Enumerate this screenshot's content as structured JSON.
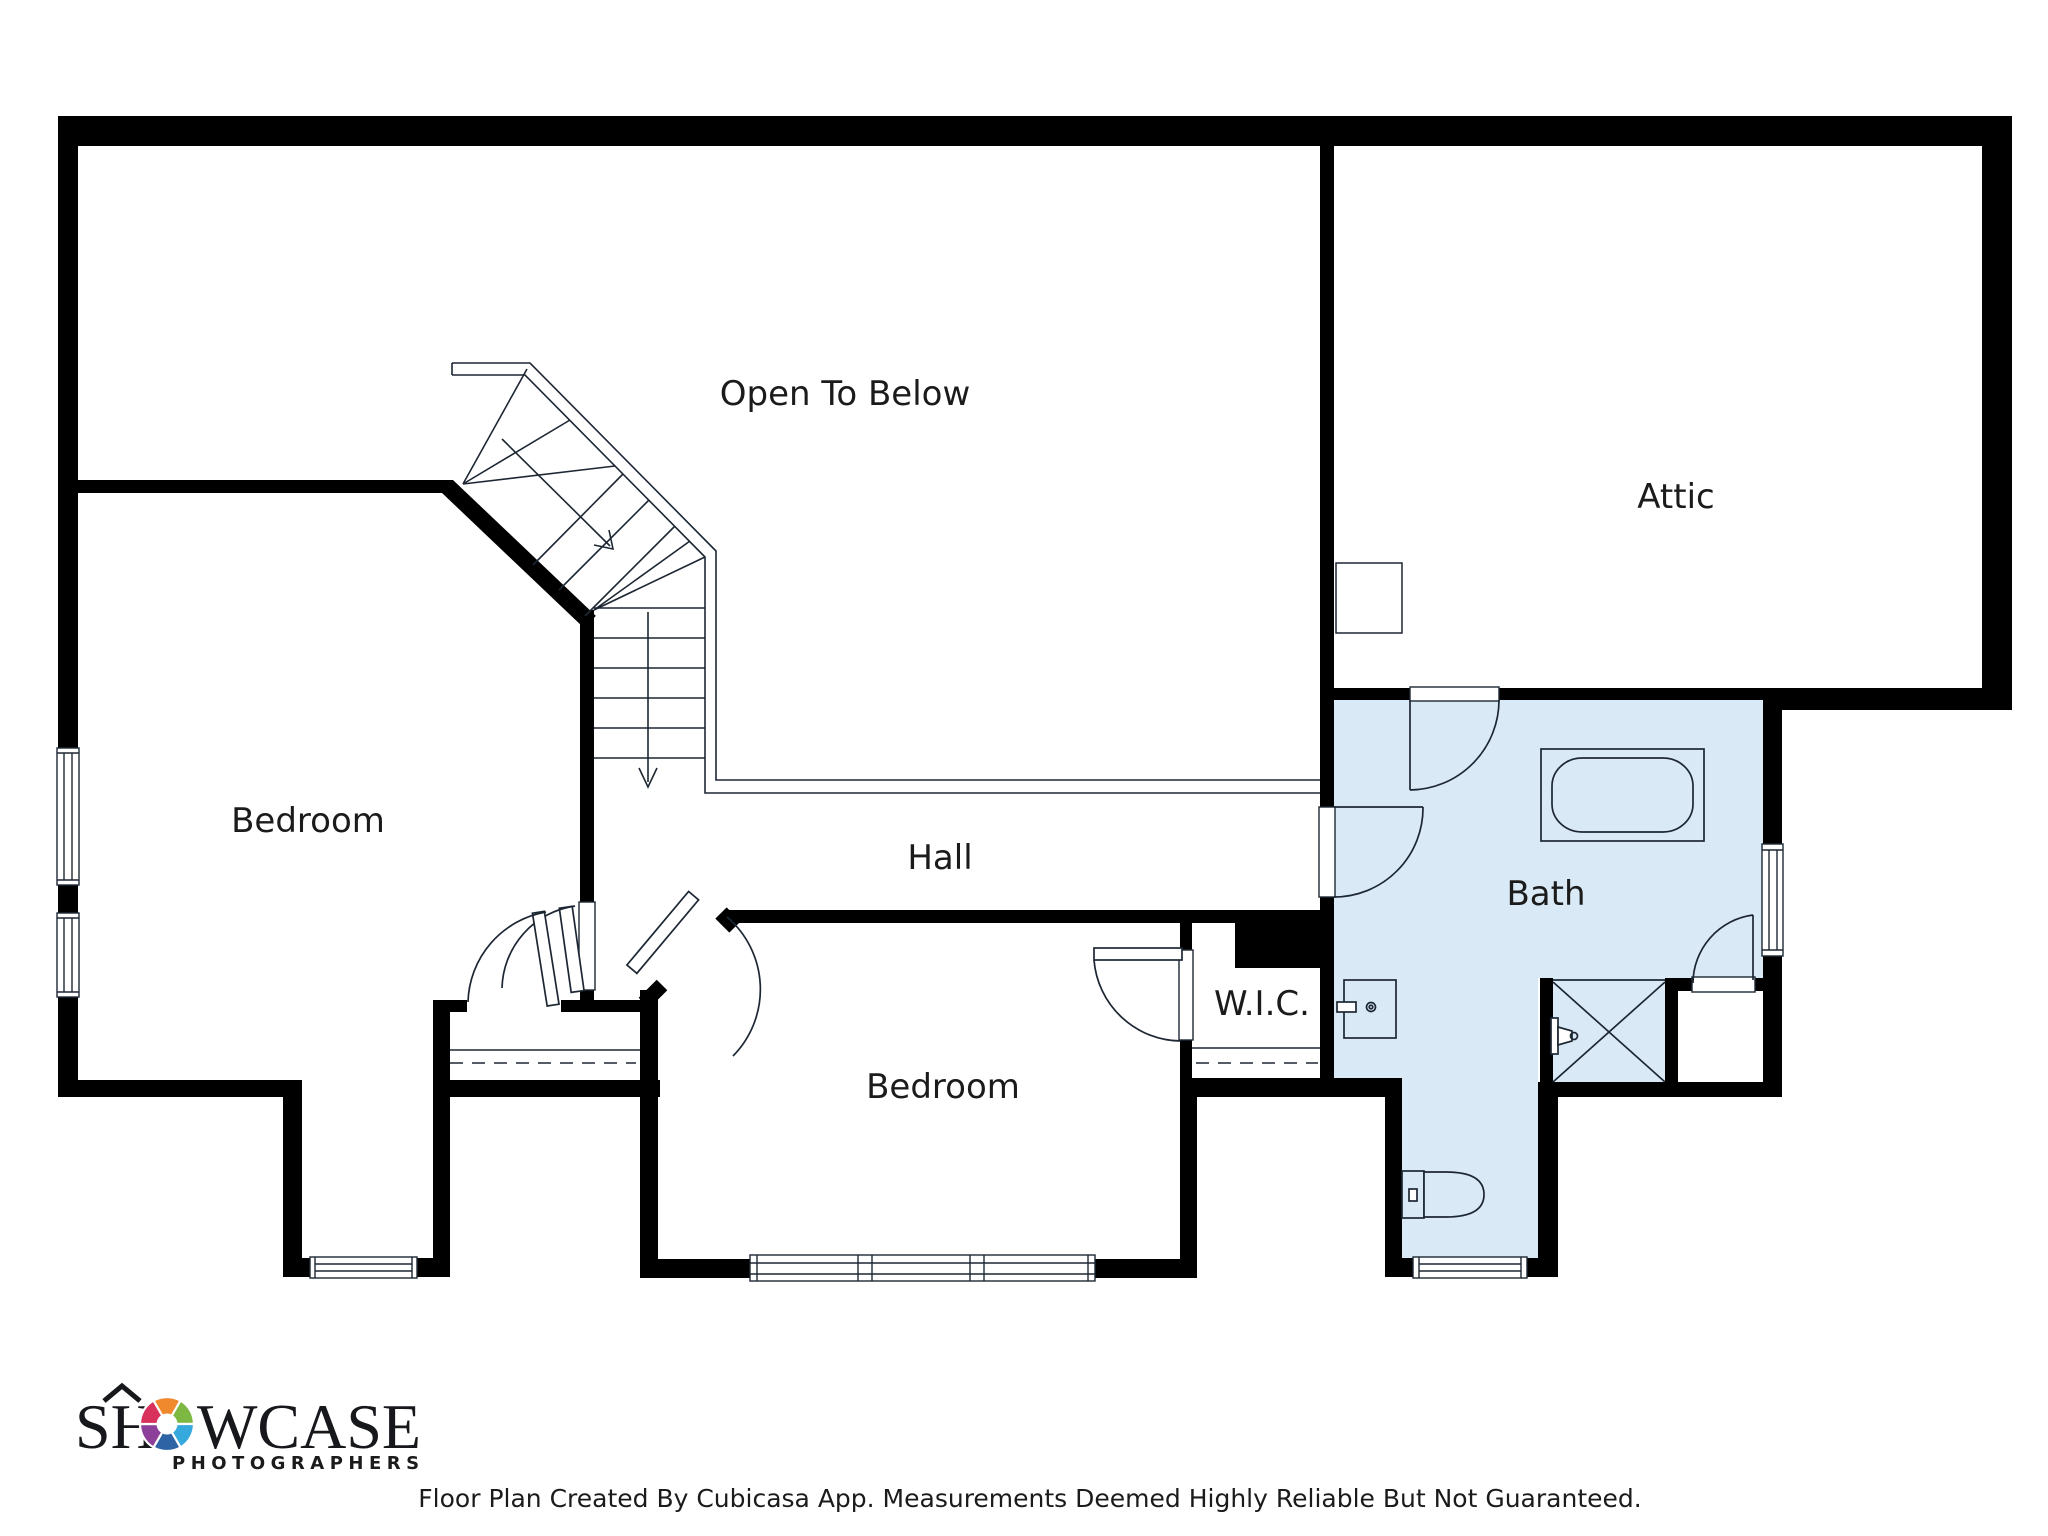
{
  "page": {
    "background": "#ffffff"
  },
  "floor_plan": {
    "rooms": {
      "open_to_below": {
        "label": "Open To Below"
      },
      "attic": {
        "label": "Attic"
      },
      "bedroom_left": {
        "label": "Bedroom"
      },
      "hall": {
        "label": "Hall"
      },
      "bedroom_center": {
        "label": "Bedroom"
      },
      "wic": {
        "label": "W.I.C."
      },
      "bath": {
        "label": "Bath",
        "fill": "#d9e9f6"
      }
    },
    "colors": {
      "wall": "#000000",
      "line": "#1d2733",
      "bath_fill": "#d9e9f6"
    },
    "fixtures": {
      "bathtub": "bathtub",
      "shower": "shower",
      "sink_vanity": "sink-vanity",
      "toilet": "toilet",
      "attic_access": "attic-access-hatch"
    }
  },
  "branding": {
    "logo_primary_left": "SH",
    "logo_primary_right": "WCASE",
    "logo_secondary": "PHOTOGRAPHERS",
    "logo_secondary_color": "#2e75b5",
    "aperture_colors": [
      "#f0882d",
      "#7db843",
      "#35a8dd",
      "#2e63a6",
      "#8d4099",
      "#d8315b"
    ]
  },
  "footer": {
    "disclaimer": "Floor Plan Created By Cubicasa App. Measurements Deemed Highly Reliable But Not Guaranteed."
  }
}
